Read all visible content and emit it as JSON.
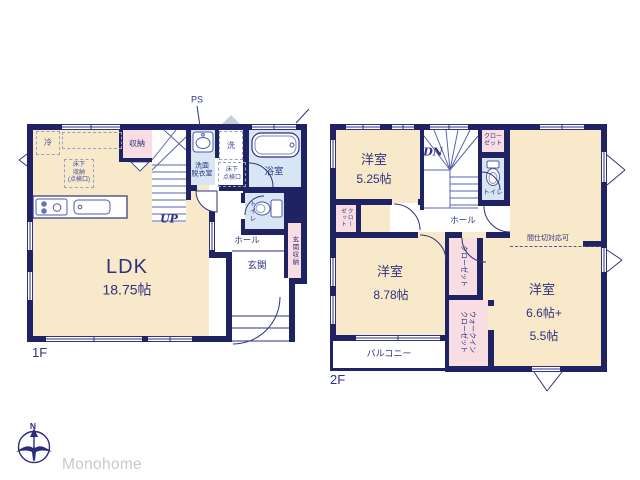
{
  "palette": {
    "wall": "#1f2363",
    "cream": "#f7e9c9",
    "pink": "#f8dde2",
    "blue": "#d8e6f3",
    "line": "#2e3280",
    "text": "#2e3280",
    "dash": "#9aa0c8",
    "gray_logo": "#c9c9ca",
    "vent": "#c8cede"
  },
  "floor1": {
    "floor_label": "1F",
    "ldk_name": "LDK",
    "ldk_size": "18.75帖",
    "storage": "収納",
    "fridge": "冷",
    "underfloor_storage": "床下\n収納\n(点検口)",
    "stairs_up": "UP",
    "ps": "PS",
    "washer": "洗",
    "washroom": "洗面\n脱衣室",
    "underfloor_hatch": "床下\n点検口",
    "bathroom": "浴室",
    "toilet": "トイレ",
    "hall": "ホール",
    "entrance": "玄関",
    "entrance_storage": "玄関収納"
  },
  "floor2": {
    "floor_label": "2F",
    "room1_name": "洋室",
    "room1_size": "5.25帖",
    "room2_name": "洋室",
    "room2_size": "8.78帖",
    "room3_name": "洋室",
    "room3_size1": "6.6帖+",
    "room3_size2": "5.5帖",
    "stairs_down": "DN",
    "closet_top": "クロー\nゼット",
    "closet_left": "クロー\nゼット",
    "closet_center": "クローゼット",
    "walk_in_closet": "ウォークイン\nクローゼット",
    "toilet": "トイレ",
    "hall": "ホール",
    "partition_note": "間仕切対応可",
    "balcony": "バルコニー"
  },
  "footer": {
    "compass_n": "N",
    "brand": "Monohome"
  }
}
